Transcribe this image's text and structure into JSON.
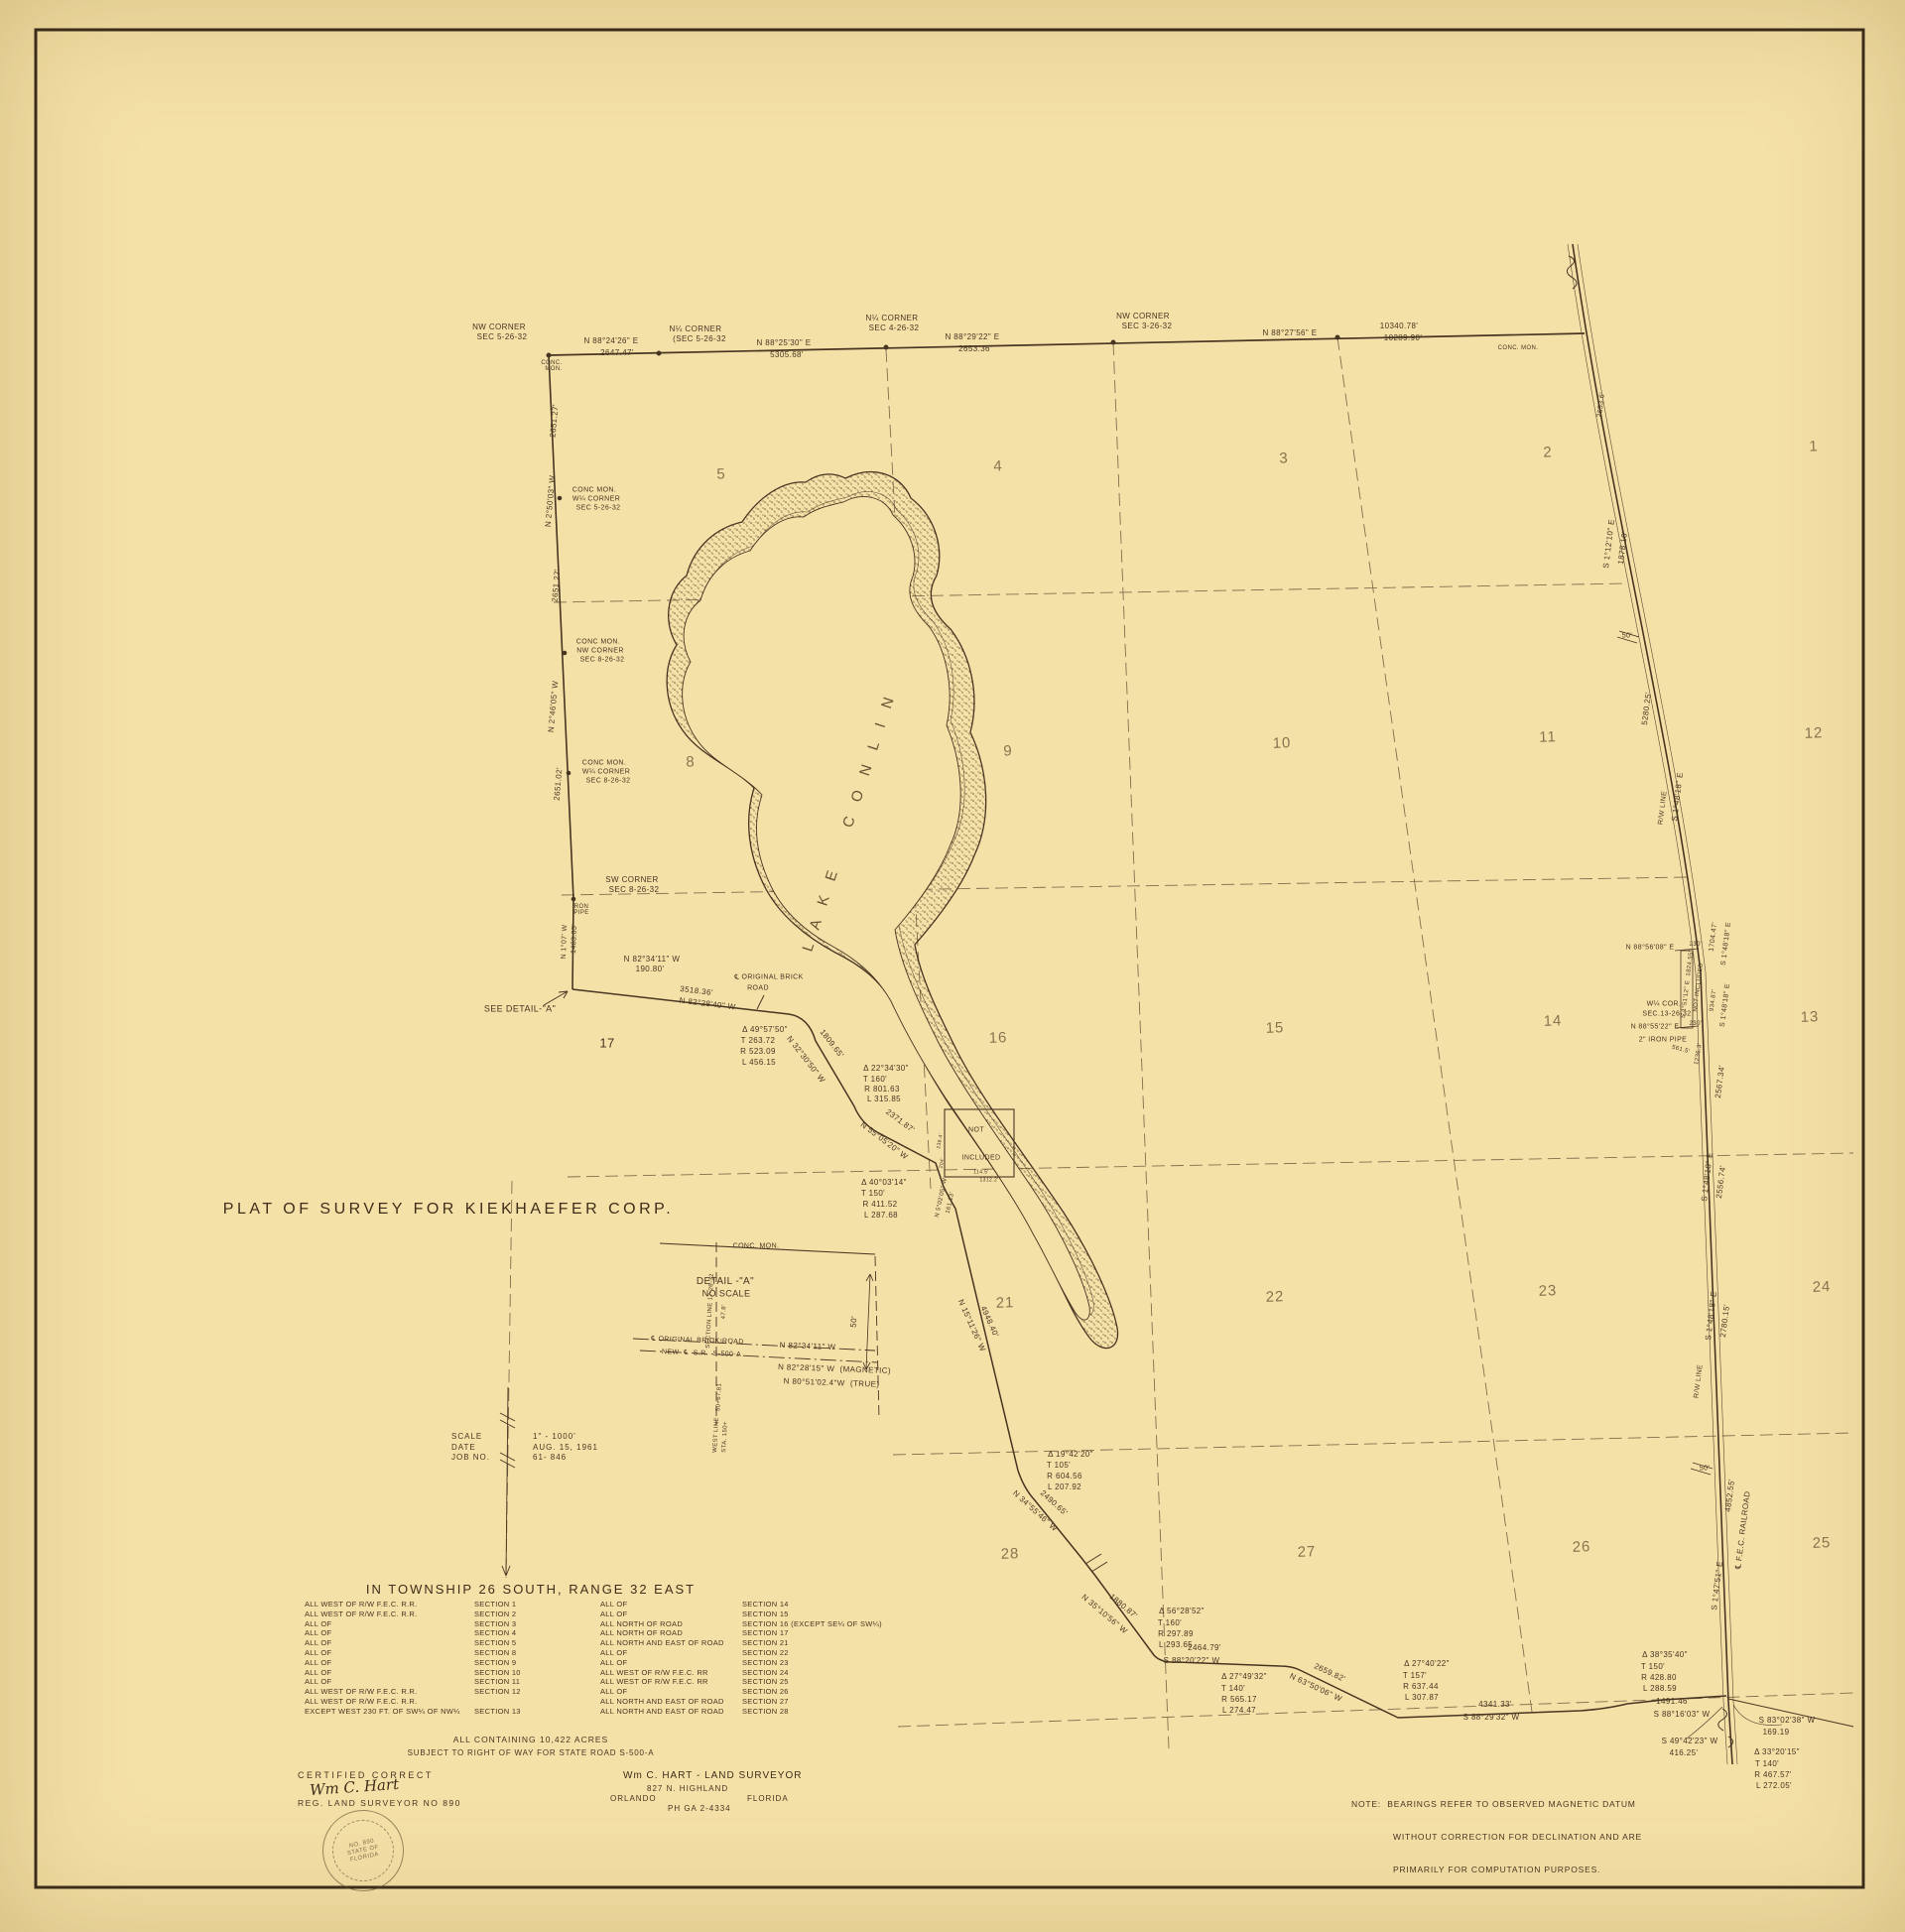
{
  "title": "PLAT OF SURVEY FOR KIEKHAEFER CORP.",
  "colors": {
    "paper": "#f4e1a8",
    "ink": "#473522",
    "grid": "#5d4930"
  },
  "lake_name": "LAKE CONLIN",
  "scale_block": {
    "rows": [
      [
        "SCALE",
        "1\" - 1000'"
      ],
      [
        "DATE",
        "AUG. 15, 1961"
      ],
      [
        "JOB NO.",
        "61- 846"
      ]
    ]
  },
  "township": {
    "heading": "IN TOWNSHIP 26 SOUTH, RANGE 32 EAST",
    "left": [
      [
        "ALL WEST OF R/W F.E.C. R.R.",
        "SECTION 1"
      ],
      [
        "ALL WEST OF R/W F.E.C. R.R.",
        "SECTION 2"
      ],
      [
        "ALL OF",
        "SECTION 3"
      ],
      [
        "ALL OF",
        "SECTION 4"
      ],
      [
        "ALL OF",
        "SECTION 5"
      ],
      [
        "ALL OF",
        "SECTION 8"
      ],
      [
        "ALL OF",
        "SECTION 9"
      ],
      [
        "ALL OF",
        "SECTION 10"
      ],
      [
        "ALL OF",
        "SECTION 11"
      ],
      [
        "ALL WEST OF R/W F.E.C. R.R.",
        "SECTION 12"
      ],
      [
        "ALL WEST OF R/W F.E.C. R.R.",
        ""
      ],
      [
        "EXCEPT WEST 230 FT. OF SW¼ OF NW¼",
        "SECTION 13"
      ]
    ],
    "right": [
      [
        "ALL OF",
        "SECTION 14"
      ],
      [
        "ALL OF",
        "SECTION 15"
      ],
      [
        "ALL NORTH OF ROAD",
        "SECTION 16 (EXCEPT SE¼ OF SW¼)"
      ],
      [
        "ALL NORTH OF ROAD",
        "SECTION 17"
      ],
      [
        "ALL NORTH AND EAST OF ROAD",
        "SECTION 21"
      ],
      [
        "ALL OF",
        "SECTION 22"
      ],
      [
        "ALL OF",
        "SECTION 23"
      ],
      [
        "ALL WEST OF R/W F.E.C. RR",
        "SECTION 24"
      ],
      [
        "ALL WEST OF R/W F.E.C. RR",
        "SECTION 25"
      ],
      [
        "ALL OF",
        "SECTION 26"
      ],
      [
        "ALL NORTH AND EAST OF ROAD",
        "SECTION 27"
      ],
      [
        "ALL NORTH AND EAST OF ROAD",
        "SECTION 28"
      ]
    ],
    "containing": "ALL CONTAINING 10,422 ACRES",
    "subject": "SUBJECT TO RIGHT OF WAY FOR STATE ROAD S-500-A"
  },
  "certification": {
    "heading": "CERTIFIED CORRECT",
    "signature": "Wm C. Hart",
    "reg": "REG. LAND SURVEYOR NO 890",
    "seal": [
      "NO. 890",
      "STATE OF",
      "FLORIDA"
    ]
  },
  "surveyor": {
    "name": "Wm C. HART - LAND SURVEYOR",
    "address": "827 N. HIGHLAND",
    "city": "ORLANDO",
    "state": "FLORIDA",
    "phone": "PH GA 2-4334"
  },
  "note": {
    "l1": "NOTE:  BEARINGS REFER TO OBSERVED MAGNETIC DATUM",
    "l2": "WITHOUT CORRECTION FOR DECLINATION AND ARE",
    "l3": "PRIMARILY FOR COMPUTATION PURPOSES."
  },
  "sections": [
    [
      "5",
      727,
      478
    ],
    [
      "4",
      1006,
      470
    ],
    [
      "3",
      1294,
      462
    ],
    [
      "2",
      1560,
      456
    ],
    [
      "1",
      1828,
      450
    ],
    [
      "8",
      696,
      768
    ],
    [
      "9",
      1016,
      757
    ],
    [
      "10",
      1292,
      749
    ],
    [
      "11",
      1560,
      743
    ],
    [
      "12",
      1828,
      739
    ],
    [
      "16",
      1006,
      1046
    ],
    [
      "15",
      1285,
      1036
    ],
    [
      "14",
      1565,
      1029
    ],
    [
      "13",
      1824,
      1025
    ],
    [
      "21",
      1013,
      1313
    ],
    [
      "22",
      1285,
      1307
    ],
    [
      "23",
      1560,
      1301
    ],
    [
      "24",
      1836,
      1297
    ],
    [
      "28",
      1018,
      1566
    ],
    [
      "27",
      1317,
      1564
    ],
    [
      "26",
      1594,
      1559
    ],
    [
      "25",
      1836,
      1555
    ]
  ],
  "labels": [
    [
      "NW CORNER",
      503,
      330,
      0,
      8
    ],
    [
      "SEC 5-26-32",
      506,
      340,
      0,
      8
    ],
    [
      "N 88°24'26\" E",
      616,
      344,
      0,
      8
    ],
    [
      "2647.47'",
      622,
      356,
      0,
      8
    ],
    [
      "CONC.",
      556,
      366,
      0,
      6
    ],
    [
      "MON.",
      558,
      372,
      0,
      6
    ],
    [
      "N¼ CORNER",
      701,
      332,
      0,
      8
    ],
    [
      "(SEC 5-26-32",
      705,
      342,
      0,
      8
    ],
    [
      "N 88°25'30\" E",
      790,
      346,
      0,
      8
    ],
    [
      "5305.68'",
      793,
      358,
      0,
      8
    ],
    [
      "N¼ CORNER",
      899,
      321,
      0,
      8
    ],
    [
      "SEC 4-26-32",
      901,
      331,
      0,
      8
    ],
    [
      "N 88°29'22\" E",
      980,
      340,
      0,
      8
    ],
    [
      "2653.36'",
      983,
      352,
      0,
      8
    ],
    [
      "NW CORNER",
      1152,
      319,
      0,
      8
    ],
    [
      "SEC 3-26-32",
      1156,
      329,
      0,
      8
    ],
    [
      "N 88°27'56\" E",
      1300,
      336,
      0,
      8
    ],
    [
      "10340.78'",
      1410,
      329,
      0,
      8
    ],
    [
      "10289.90'",
      1414,
      341,
      0,
      8
    ],
    [
      "CONC. MON.",
      1530,
      351,
      0,
      6
    ],
    [
      "2651.27'",
      559,
      424,
      -85,
      8
    ],
    [
      "N 2°50'03\" W",
      555,
      505,
      -85,
      8
    ],
    [
      "CONC MON.",
      599,
      494,
      0,
      7
    ],
    [
      "W¼ CORNER",
      601,
      503,
      0,
      7
    ],
    [
      "SEC 5-26-32",
      603,
      512,
      0,
      7
    ],
    [
      "2651.27'",
      561,
      590,
      -85,
      8
    ],
    [
      "CONC MON.",
      603,
      647,
      0,
      7
    ],
    [
      "NW CORNER",
      605,
      656,
      0,
      7
    ],
    [
      "SEC 8-26-32",
      607,
      665,
      0,
      7
    ],
    [
      "N 2°46'05\" W",
      558,
      712,
      -85,
      8
    ],
    [
      "2651.02'",
      563,
      790,
      -85,
      8
    ],
    [
      "CONC MON.",
      609,
      769,
      0,
      7
    ],
    [
      "W¼ CORNER",
      611,
      778,
      0,
      7
    ],
    [
      "SEC 8-26-32",
      613,
      787,
      0,
      7
    ],
    [
      "SW CORNER",
      637,
      887,
      0,
      8
    ],
    [
      "SEC 8-26-32",
      639,
      897,
      0,
      8
    ],
    [
      "IRON",
      585,
      914,
      0,
      6
    ],
    [
      "PIPE",
      586,
      920,
      0,
      6
    ],
    [
      "N 1°07' W",
      569,
      949,
      -88,
      7
    ],
    [
      "1463.05'",
      579,
      946,
      -88,
      7
    ],
    [
      "N 82°34'11\" W",
      657,
      967,
      0,
      8
    ],
    [
      "190.80'",
      655,
      977,
      0,
      8
    ],
    [
      "SEE DETAIL-\"A\"",
      524,
      1017,
      0,
      9
    ],
    [
      "3518.36'",
      702,
      999,
      7,
      8
    ],
    [
      "N 82°28'40\" W",
      713,
      1012,
      7,
      8
    ],
    [
      "℄ ORIGINAL BRICK",
      775,
      985,
      0,
      7
    ],
    [
      "ROAD",
      764,
      996,
      0,
      7
    ],
    [
      "17",
      612,
      1051,
      0,
      13
    ],
    [
      "Δ 49°57'50\"",
      771,
      1038,
      0,
      8
    ],
    [
      "T 263.72",
      764,
      1049,
      0,
      8
    ],
    [
      "R 523.09",
      764,
      1060,
      0,
      8
    ],
    [
      "L 456.15",
      765,
      1071,
      0,
      8
    ],
    [
      "1809.65'",
      838,
      1052,
      52,
      8
    ],
    [
      "N 32°30'50\" W",
      812,
      1068,
      52,
      8
    ],
    [
      "Δ 22°34'30\"",
      893,
      1077,
      0,
      8
    ],
    [
      "T 160'",
      882,
      1088,
      0,
      8
    ],
    [
      "R 801.63",
      889,
      1098,
      0,
      8
    ],
    [
      "L 315.85",
      891,
      1108,
      0,
      8
    ],
    [
      "2371.87'",
      907,
      1130,
      37,
      8
    ],
    [
      "N 55°05'20\" W",
      891,
      1150,
      37,
      8
    ],
    [
      "NOT",
      984,
      1139,
      0,
      7
    ],
    [
      "INCLUDED",
      989,
      1167,
      0,
      7
    ],
    [
      "238.4'",
      948,
      1150,
      -80,
      5
    ],
    [
      "204'",
      950,
      1172,
      -80,
      5
    ],
    [
      "114.5'",
      989,
      1182,
      0,
      5
    ],
    [
      "1312.2'",
      997,
      1190,
      0,
      5
    ],
    [
      "N 5°02'05\" W",
      949,
      1207,
      -78,
      6
    ],
    [
      "161.13'",
      958,
      1212,
      -78,
      6
    ],
    [
      "Δ 40°03'14\"",
      891,
      1192,
      0,
      8
    ],
    [
      "T 150'",
      880,
      1203,
      0,
      8
    ],
    [
      "R 411.52",
      887,
      1214,
      0,
      8
    ],
    [
      "L 287.68",
      888,
      1225,
      0,
      8
    ],
    [
      "4948.40'",
      997,
      1332,
      66,
      8
    ],
    [
      "N 15°11'26\" W",
      979,
      1336,
      66,
      8
    ],
    [
      "Δ 19°42'20\"",
      1079,
      1466,
      0,
      8
    ],
    [
      "T 105'",
      1067,
      1477,
      0,
      8
    ],
    [
      "R 604.56",
      1073,
      1488,
      0,
      8
    ],
    [
      "L 207.92",
      1073,
      1499,
      0,
      8
    ],
    [
      "2490.65'",
      1062,
      1515,
      42,
      8
    ],
    [
      "N 34°55'46\" W",
      1043,
      1523,
      42,
      8
    ],
    [
      "N 35°10'56\" W",
      1113,
      1627,
      40,
      8
    ],
    [
      "1880.87'",
      1132,
      1619,
      40,
      8
    ],
    [
      "Δ 56°28'52\"",
      1191,
      1624,
      0,
      8
    ],
    [
      "T 160'",
      1179,
      1636,
      0,
      8
    ],
    [
      "R 297.89",
      1185,
      1647,
      0,
      8
    ],
    [
      "L 293.65",
      1185,
      1658,
      0,
      8
    ],
    [
      "2464.79'",
      1214,
      1661,
      0,
      8
    ],
    [
      "S 88°20'22\" W",
      1201,
      1674,
      0,
      8
    ],
    [
      "Δ 27°49'32\"",
      1254,
      1690,
      0,
      8
    ],
    [
      "T 140'",
      1243,
      1702,
      0,
      8
    ],
    [
      "R 565.17",
      1249,
      1713,
      0,
      8
    ],
    [
      "L 274.47",
      1249,
      1724,
      0,
      8
    ],
    [
      "2659.82'",
      1340,
      1686,
      25,
      8
    ],
    [
      "N 63°50'06\" W",
      1326,
      1701,
      25,
      8
    ],
    [
      "Δ 27°40'22\"",
      1438,
      1677,
      0,
      8
    ],
    [
      "T 157'",
      1426,
      1689,
      0,
      8
    ],
    [
      "R 637.44",
      1432,
      1700,
      0,
      8
    ],
    [
      "L 307.87",
      1433,
      1711,
      0,
      8
    ],
    [
      "4341.33'",
      1507,
      1718,
      0,
      8
    ],
    [
      "S 88°29'32\" W",
      1503,
      1731,
      0,
      8
    ],
    [
      "Δ 38°35'40\"",
      1678,
      1668,
      0,
      8
    ],
    [
      "T 150'",
      1666,
      1680,
      0,
      8
    ],
    [
      "R 428.80",
      1672,
      1691,
      0,
      8
    ],
    [
      "L 288.59",
      1673,
      1702,
      0,
      8
    ],
    [
      "1491.46'",
      1686,
      1715,
      0,
      8
    ],
    [
      "S 88°16'03\" W",
      1695,
      1728,
      0,
      8
    ],
    [
      "S 83°02'38\" W",
      1801,
      1734,
      0,
      8
    ],
    [
      "169.19",
      1790,
      1746,
      0,
      8
    ],
    [
      "S 49°42'23\" W",
      1703,
      1755,
      0,
      8
    ],
    [
      "416.25'",
      1697,
      1767,
      0,
      8
    ],
    [
      "Δ 33°20'15\"",
      1791,
      1766,
      0,
      8
    ],
    [
      "T 140'",
      1781,
      1778,
      0,
      8
    ],
    [
      "R 467.57'",
      1787,
      1789,
      0,
      8
    ],
    [
      "L 272.05'",
      1788,
      1800,
      0,
      8
    ],
    [
      "2653.6'",
      1614,
      408,
      -83,
      7
    ],
    [
      "S 1°12'10\" E",
      1622,
      548,
      -83,
      8
    ],
    [
      "1878.10'",
      1636,
      552,
      -83,
      8
    ],
    [
      "50'",
      1640,
      641,
      0,
      7
    ],
    [
      "5280.25'",
      1660,
      714,
      -83,
      8
    ],
    [
      "R/W LINE",
      1676,
      814,
      -83,
      7
    ],
    [
      "S 1°48'18\" E",
      1691,
      803,
      -83,
      8
    ],
    [
      "N 88°56'08\" E",
      1663,
      955,
      0,
      7
    ],
    [
      "230'",
      1709,
      952,
      0,
      6
    ],
    [
      "S 1°51'12\" E  1824.55'",
      1701,
      992,
      -83,
      6
    ],
    [
      "NOT INCLUDED",
      1712,
      995,
      -83,
      6
    ],
    [
      "1704.47'",
      1727,
      944,
      -83,
      7
    ],
    [
      "S 1°48'18\" E",
      1740,
      951,
      -83,
      7
    ],
    [
      "W¼ COR.",
      1677,
      1012,
      0,
      7
    ],
    [
      "SEC.13-26-32",
      1680,
      1022,
      0,
      7
    ],
    [
      "N 88°55'22\" E",
      1668,
      1035,
      0,
      7
    ],
    [
      "230'",
      1709,
      1032,
      0,
      6
    ],
    [
      "2\" IRON PIPE",
      1676,
      1048,
      0,
      7
    ],
    [
      "561.5'",
      1694,
      1058,
      15,
      6
    ],
    [
      "1236.3'",
      1712,
      1062,
      -80,
      6
    ],
    [
      "934.87'",
      1727,
      1008,
      -83,
      6
    ],
    [
      "S 1°48'18\" E",
      1739,
      1013,
      -83,
      7
    ],
    [
      "2567.34'",
      1734,
      1090,
      -83,
      8
    ],
    [
      "S 1°48'18\" E",
      1721,
      1186,
      -83,
      8
    ],
    [
      "2556.74'",
      1735,
      1191,
      -83,
      8
    ],
    [
      "S 1°48'18\" E",
      1725,
      1326,
      -83,
      8
    ],
    [
      "2780.15'",
      1739,
      1331,
      -83,
      8
    ],
    [
      "R/W LINE",
      1712,
      1392,
      -83,
      7
    ],
    [
      "50'",
      1718,
      1480,
      0,
      7
    ],
    [
      "4852.55'",
      1744,
      1507,
      -83,
      8
    ],
    [
      "S 1°47'51\" E",
      1731,
      1598,
      -83,
      8
    ],
    [
      "℄ F.E.C. RAILROAD",
      1757,
      1542,
      -83,
      8
    ],
    [
      "CONC. MON.",
      762,
      1256,
      0,
      7
    ],
    [
      "DETAIL -\"A\"",
      731,
      1292,
      0,
      10
    ],
    [
      "NO SCALE",
      732,
      1304,
      0,
      9
    ],
    [
      "SECTION LINE 17-26-32",
      716,
      1321,
      -87,
      6
    ],
    [
      "47.8'",
      730,
      1322,
      -87,
      6
    ],
    [
      "27.1",
      723,
      1353,
      0,
      5
    ],
    [
      "50'",
      861,
      1332,
      -85,
      8
    ],
    [
      "℄ ORIGINAL BRICK ROAD",
      703,
      1351,
      2,
      7
    ],
    [
      "N 82°34'11\" W",
      814,
      1357,
      2,
      8
    ],
    [
      "NEW  ℄  S.R.  S-500-A",
      707,
      1364,
      2,
      7
    ],
    [
      "N 82°28'15\" W  (MAGNETIC)",
      841,
      1380,
      2,
      8
    ],
    [
      "N 80°51'02.4\"W  (TRUE)",
      838,
      1394,
      2,
      8
    ],
    [
      "50+67.81",
      725,
      1408,
      -87,
      6
    ],
    [
      "WEST LINE",
      722,
      1446,
      -87,
      6
    ],
    [
      "STA. 150+",
      731,
      1448,
      -87,
      6
    ],
    [
      "L A K E    C O N L I N",
      856,
      828,
      -72,
      15,
      "lake"
    ]
  ]
}
